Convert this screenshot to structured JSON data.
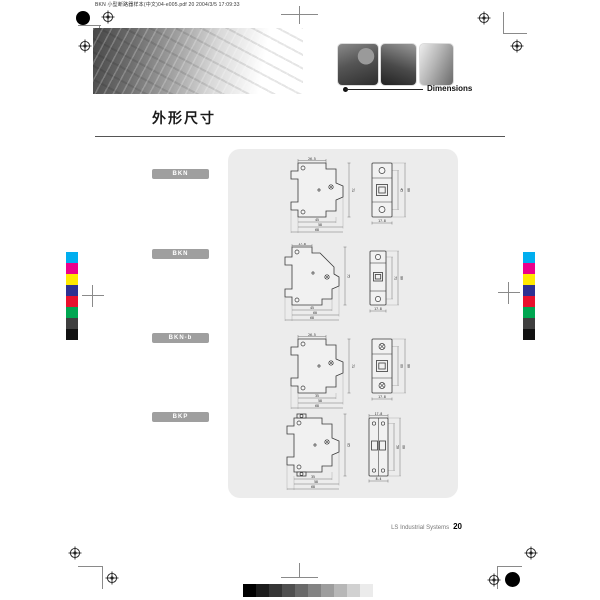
{
  "print": {
    "slug": "BKN 小型断路器样本(中文)04-e005.pdf  20  2004/3/5  17:09:33",
    "color_bar": [
      "#00aeef",
      "#ec008c",
      "#ffe900",
      "#2e3192",
      "#e8112d",
      "#00a651",
      "#3f3f3f",
      "#111111"
    ],
    "grayscale_bar": [
      "#000000",
      "#1c1c1c",
      "#353535",
      "#4f4f4f",
      "#696969",
      "#838383",
      "#9d9d9d",
      "#b7b7b7",
      "#d1d1d1",
      "#ebebeb"
    ]
  },
  "header": {
    "section_label": "Dimensions",
    "title": "外形尺寸"
  },
  "models": [
    {
      "label": "BKN",
      "dims": {
        "top": [
          "26.5"
        ],
        "bottom": [
          "45",
          "58",
          "68"
        ],
        "right": [
          "71"
        ],
        "front_right": [
          "45",
          "80"
        ],
        "front_bottom": [
          "17.8"
        ]
      }
    },
    {
      "label": "BKN",
      "dims": {
        "top": [
          "17.8"
        ],
        "bottom": [
          "45",
          "60",
          "68"
        ],
        "right": [
          "75"
        ],
        "front_right": [
          "71",
          "80"
        ],
        "front_bottom": [
          "17.8"
        ]
      }
    },
    {
      "label": "BKN-b",
      "dims": {
        "top": [
          "26.5"
        ],
        "bottom": [
          "35",
          "58",
          "68"
        ],
        "right": [
          "71"
        ],
        "front_right": [
          "66",
          "80"
        ],
        "front_bottom": [
          "17.8"
        ]
      }
    },
    {
      "label": "BKP",
      "dims": {
        "top": [
          "17.8"
        ],
        "bottom": [
          "35",
          "58",
          "68"
        ],
        "right": [
          "65"
        ],
        "front_right": [
          "50",
          "60"
        ],
        "front_bottom": [
          "8.4"
        ]
      }
    }
  ],
  "footer": {
    "brand": "LS Industrial Systems",
    "page": "20"
  }
}
